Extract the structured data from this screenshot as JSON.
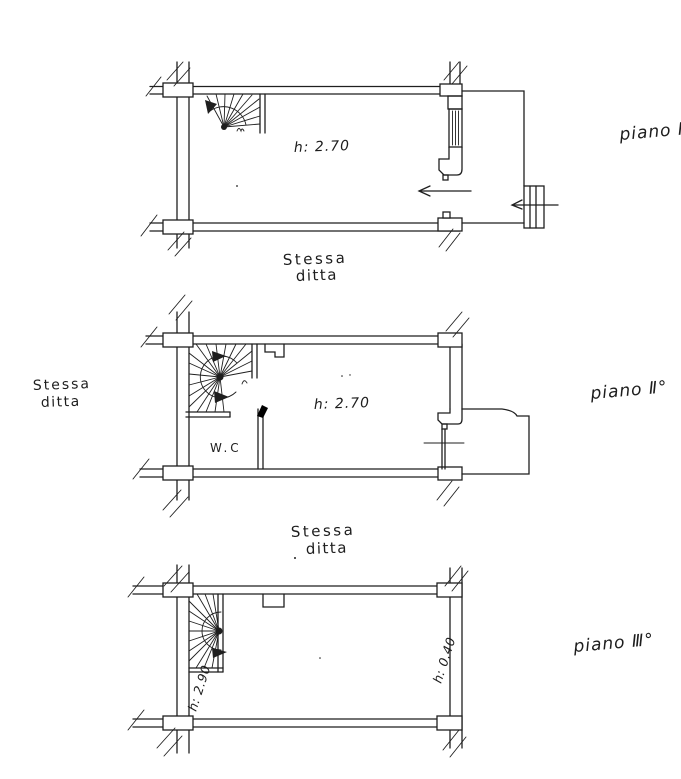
{
  "drawing": {
    "type": "architectural floor plans, hand-drawn scan",
    "ink_color": "#1f1f1f",
    "paper_color": "#ffffff"
  },
  "plans": [
    {
      "floor_label": "piano I",
      "room_height": "h: 2.70",
      "caption_line1": "Stessa",
      "caption_line2": "ditta"
    },
    {
      "floor_label": "piano Ⅱ°",
      "room_height": "h: 2.70",
      "wc_label": "W.C",
      "left_caption_line1": "Stessa",
      "left_caption_line2": "ditta",
      "bottom_caption_line1": "Stessa",
      "bottom_caption_line2": "ditta"
    },
    {
      "floor_label": "piano Ⅲ°",
      "left_height": "h: 2.90",
      "right_height": "h: 0.40"
    }
  ]
}
